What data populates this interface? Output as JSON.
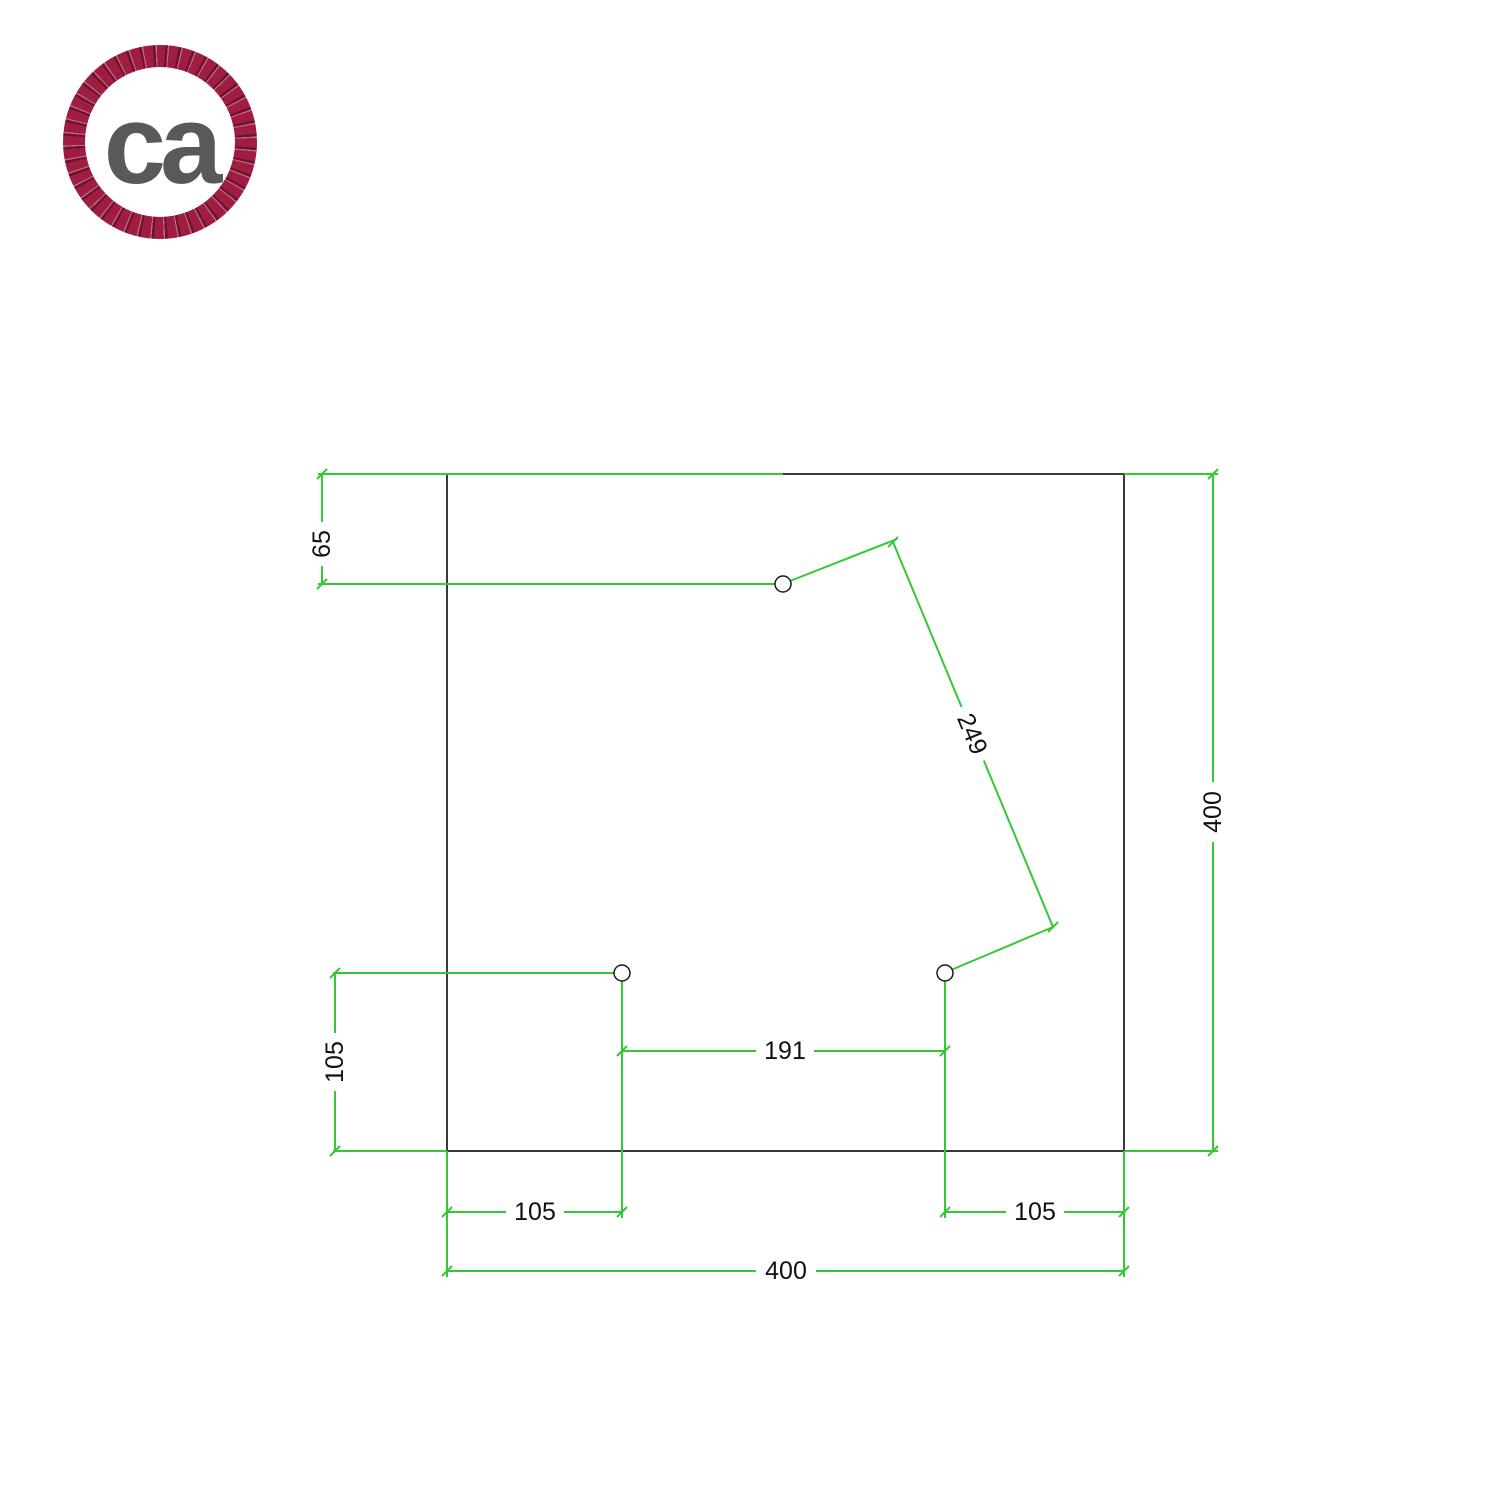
{
  "logo": {
    "text": "ca",
    "rope_color": "#9e1d40",
    "text_color": "#58595b"
  },
  "diagram": {
    "accent_color": "#35c835",
    "outline_color": "#3a3a3a",
    "label_color": "#111111",
    "plate": {
      "shape": "square",
      "holes_count": 3
    },
    "dimensions": {
      "top_hole_vertical_offset": "65",
      "left_hole_vertical_offset": "105",
      "bottom_holes_spacing": "191",
      "diagonal_holes_spacing": "249",
      "bottom_left_hole_offset": "105",
      "bottom_right_hole_offset": "105",
      "plate_width": "400",
      "plate_height": "400"
    }
  }
}
